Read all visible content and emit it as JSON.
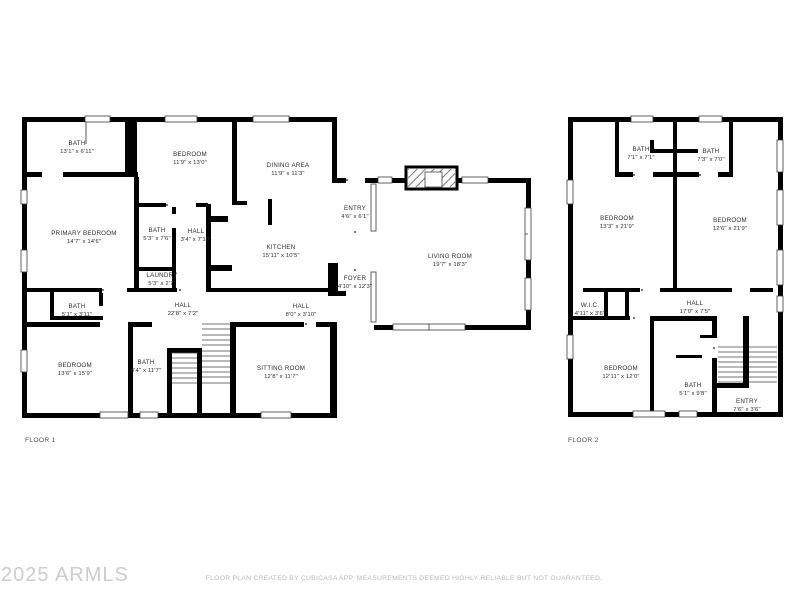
{
  "colors": {
    "background": "#ffffff",
    "wall": "#000000",
    "room_label": "#2d2d2d",
    "floor_caption": "#4a4a4a",
    "watermark": "#cbcdce",
    "disclaimer": "#b6babb"
  },
  "floor1": {
    "caption": "FLOOR 1",
    "rooms": [
      {
        "name": "BATH",
        "dims": "13'1\" x 6'11\""
      },
      {
        "name": "BEDROOM",
        "dims": "11'9\" x 13'0\""
      },
      {
        "name": "DINING AREA",
        "dims": "11'9\" x 11'3\""
      },
      {
        "name": "PRIMARY BEDROOM",
        "dims": "14'7\" x 14'6\""
      },
      {
        "name": "BATH",
        "dims": "5'3\" x 7'6\""
      },
      {
        "name": "HALL",
        "dims": "3'4\" x 7'10\""
      },
      {
        "name": "KITCHEN",
        "dims": "15'11\" x 10'5\""
      },
      {
        "name": "LAUNDRY",
        "dims": "5'3\" x 2'7\""
      },
      {
        "name": "ENTRY",
        "dims": "4'6\" x 6'1\""
      },
      {
        "name": "FOYER",
        "dims": "4'10\" x 12'3\""
      },
      {
        "name": "LIVING ROOM",
        "dims": "19'7\" x 18'3\""
      },
      {
        "name": "BATH",
        "dims": "5'1\" x 3'11\""
      },
      {
        "name": "HALL",
        "dims": "22'8\" x 7'2\""
      },
      {
        "name": "HALL",
        "dims": "8'0\" x 3'10\""
      },
      {
        "name": "BEDROOM",
        "dims": "13'6\" x 15'9\""
      },
      {
        "name": "BATH",
        "dims": "8'4\" x 11'7\""
      },
      {
        "name": "SITTING ROOM",
        "dims": "12'8\" x 11'7\""
      }
    ]
  },
  "floor2": {
    "caption": "FLOOR 2",
    "rooms": [
      {
        "name": "BATH",
        "dims": "7'1\" x 7'1\""
      },
      {
        "name": "BATH",
        "dims": "7'3\" x 7'0\""
      },
      {
        "name": "BEDROOM",
        "dims": "13'3\" x 21'9\""
      },
      {
        "name": "BEDROOM",
        "dims": "12'6\" x 21'9\""
      },
      {
        "name": "W.I.C.",
        "dims": "4'11\" x 3'6\""
      },
      {
        "name": "HALL",
        "dims": "17'0\" x 7'5\""
      },
      {
        "name": "BEDROOM",
        "dims": "12'11\" x 12'0\""
      },
      {
        "name": "BATH",
        "dims": "5'1\" x 9'8\""
      },
      {
        "name": "ENTRY",
        "dims": "7'6\" x 3'6\""
      }
    ]
  },
  "footer": {
    "watermark": "2025 ARMLS",
    "disclaimer": "FLOOR PLAN CREATED BY CUBICASA APP. MEASUREMENTS DEEMED HIGHLY RELIABLE BUT NOT GUARANTEED."
  }
}
